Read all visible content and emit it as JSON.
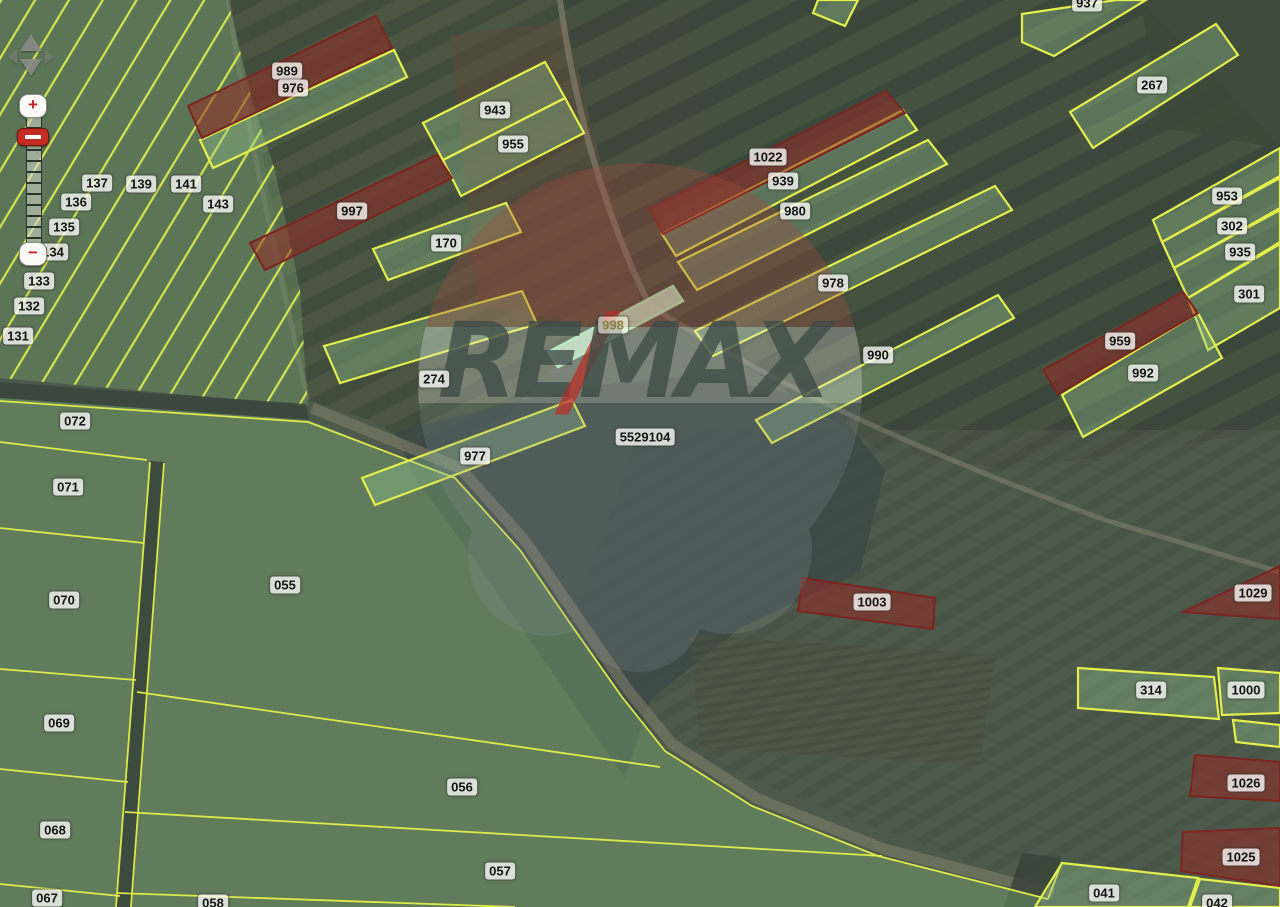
{
  "watermark": {
    "re": "RE",
    "slash": "/",
    "max": "MAX"
  },
  "controls": {
    "zoom_in_label": "+",
    "zoom_out_label": "−"
  },
  "colors": {
    "boundary": "#e3ef4c",
    "green_fill": "rgba(150,200,145,0.35)",
    "green_stroke": "#e3ef4c",
    "red_fill": "rgba(148,42,36,0.55)",
    "red_stroke": "#7c2420",
    "sel_fill": "rgba(196,236,201,0.85)",
    "sel_stroke": "#a9ecb6"
  },
  "parcels": {
    "red": [
      {
        "id": "989",
        "pts": "188,106 376,16 392,48 202,138"
      },
      {
        "id": "997",
        "pts": "250,243 437,155 452,178 265,270"
      },
      {
        "id": "1022",
        "pts": "650,209 886,91 905,113 663,234"
      },
      {
        "id": "959",
        "pts": "1043,370 1183,292 1198,313 1058,394"
      },
      {
        "id": "1003",
        "pts": "803,578 935,598 933,629 798,611"
      },
      {
        "id": "1029",
        "pts": "1183,612 1280,566 1280,619"
      },
      {
        "id": "1026",
        "pts": "1195,755 1280,762 1280,801 1190,796"
      },
      {
        "id": "1025",
        "pts": "1183,832 1280,828 1280,886 1181,871"
      }
    ],
    "green": [
      {
        "id": "976",
        "pts": "200,140 394,50 407,77 213,168"
      },
      {
        "id": "943",
        "pts": "423,123 545,62 565,98 443,160"
      },
      {
        "id": "955",
        "pts": "443,160 565,98 584,133 461,196"
      },
      {
        "id": "170",
        "pts": "373,249 506,203 521,232 388,280"
      },
      {
        "id": "274",
        "pts": "324,346 522,291 537,324 340,383"
      },
      {
        "id": "977",
        "pts": "362,478 572,400 585,426 375,505"
      },
      {
        "id": "939",
        "pts": "662,234 903,110 917,130 676,256"
      },
      {
        "id": "980",
        "pts": "678,262 928,140 947,164 697,290"
      },
      {
        "id": "978",
        "pts": "695,331 995,186 1012,210 713,356"
      },
      {
        "id": "990",
        "pts": "756,420 998,295 1014,318 772,443"
      },
      {
        "id": "937",
        "pts": "1022,14 1116,0 1146,0 1054,56 1022,42"
      },
      {
        "id": "edge-top",
        "pts": "818,0 858,0 845,26 813,13"
      },
      {
        "id": "267",
        "pts": "1070,112 1216,24 1238,55 1093,148"
      },
      {
        "id": "953",
        "pts": "1153,220 1280,148 1280,176 1162,242"
      },
      {
        "id": "302",
        "pts": "1162,242 1280,178 1280,208 1174,268"
      },
      {
        "id": "935",
        "pts": "1174,268 1280,210 1280,242 1188,298"
      },
      {
        "id": "301",
        "pts": "1188,298 1280,244 1280,308 1208,350"
      },
      {
        "id": "992",
        "pts": "1062,395 1198,313 1222,358 1083,437"
      },
      {
        "id": "314",
        "pts": "1078,668 1214,677 1219,719 1078,708"
      },
      {
        "id": "1000",
        "pts": "1218,668 1280,673 1280,713 1222,715"
      },
      {
        "id": "edge-right",
        "pts": "1233,720 1280,725 1280,747 1236,742"
      },
      {
        "id": "041",
        "pts": "1062,863 1198,878 1188,907 1035,907"
      },
      {
        "id": "042",
        "pts": "1200,879 1280,888 1280,907 1190,907"
      }
    ],
    "selected": [
      {
        "id": "998",
        "pts": "548,352 673,286 683,301 558,367"
      }
    ]
  },
  "boundaries": [
    "0,401 308,422 455,478 520,550 572,626 622,697 665,751 752,806 878,856 1048,899",
    "0,442 147,460",
    "0,528 144,543",
    "0,669 136,680",
    "0,769 128,782",
    "0,884 120,896",
    "150,462 116,907",
    "164,463 131,907",
    "137,692 660,767",
    "125,812 882,856",
    "117,893 515,907",
    "1048,899 1062,862"
  ],
  "labels": [
    {
      "t": "989",
      "x": 287,
      "y": 71
    },
    {
      "t": "976",
      "x": 293,
      "y": 88
    },
    {
      "t": "943",
      "x": 495,
      "y": 110
    },
    {
      "t": "955",
      "x": 513,
      "y": 144
    },
    {
      "t": "997",
      "x": 352,
      "y": 211
    },
    {
      "t": "170",
      "x": 446,
      "y": 243
    },
    {
      "t": "1022",
      "x": 768,
      "y": 157
    },
    {
      "t": "939",
      "x": 783,
      "y": 181
    },
    {
      "t": "980",
      "x": 795,
      "y": 211
    },
    {
      "t": "978",
      "x": 833,
      "y": 283
    },
    {
      "t": "990",
      "x": 878,
      "y": 355
    },
    {
      "t": "998",
      "x": 613,
      "y": 325,
      "style": "selected"
    },
    {
      "t": "274",
      "x": 434,
      "y": 379
    },
    {
      "t": "977",
      "x": 475,
      "y": 456
    },
    {
      "t": "5529104",
      "x": 645,
      "y": 437
    },
    {
      "t": "937",
      "x": 1087,
      "y": 3
    },
    {
      "t": "267",
      "x": 1152,
      "y": 85
    },
    {
      "t": "953",
      "x": 1227,
      "y": 196
    },
    {
      "t": "302",
      "x": 1232,
      "y": 226
    },
    {
      "t": "935",
      "x": 1240,
      "y": 252
    },
    {
      "t": "301",
      "x": 1249,
      "y": 294
    },
    {
      "t": "959",
      "x": 1120,
      "y": 341
    },
    {
      "t": "992",
      "x": 1143,
      "y": 373
    },
    {
      "t": "1003",
      "x": 872,
      "y": 602
    },
    {
      "t": "1029",
      "x": 1253,
      "y": 593
    },
    {
      "t": "314",
      "x": 1151,
      "y": 690
    },
    {
      "t": "1000",
      "x": 1246,
      "y": 690
    },
    {
      "t": "1026",
      "x": 1246,
      "y": 783
    },
    {
      "t": "1025",
      "x": 1241,
      "y": 857
    },
    {
      "t": "041",
      "x": 1104,
      "y": 893
    },
    {
      "t": "042",
      "x": 1217,
      "y": 903
    },
    {
      "t": "072",
      "x": 75,
      "y": 421
    },
    {
      "t": "071",
      "x": 68,
      "y": 487
    },
    {
      "t": "070",
      "x": 64,
      "y": 600
    },
    {
      "t": "069",
      "x": 59,
      "y": 723
    },
    {
      "t": "068",
      "x": 55,
      "y": 830
    },
    {
      "t": "067",
      "x": 47,
      "y": 898
    },
    {
      "t": "055",
      "x": 285,
      "y": 585
    },
    {
      "t": "056",
      "x": 462,
      "y": 787
    },
    {
      "t": "057",
      "x": 500,
      "y": 871
    },
    {
      "t": "058",
      "x": 213,
      "y": 903
    },
    {
      "t": "137",
      "x": 97,
      "y": 183
    },
    {
      "t": "139",
      "x": 141,
      "y": 184
    },
    {
      "t": "141",
      "x": 186,
      "y": 184
    },
    {
      "t": "143",
      "x": 218,
      "y": 204
    },
    {
      "t": "136",
      "x": 76,
      "y": 202
    },
    {
      "t": "135",
      "x": 64,
      "y": 227
    },
    {
      "t": "134",
      "x": 53,
      "y": 252
    },
    {
      "t": "133",
      "x": 39,
      "y": 281
    },
    {
      "t": "132",
      "x": 29,
      "y": 306
    },
    {
      "t": "131",
      "x": 18,
      "y": 336
    }
  ]
}
